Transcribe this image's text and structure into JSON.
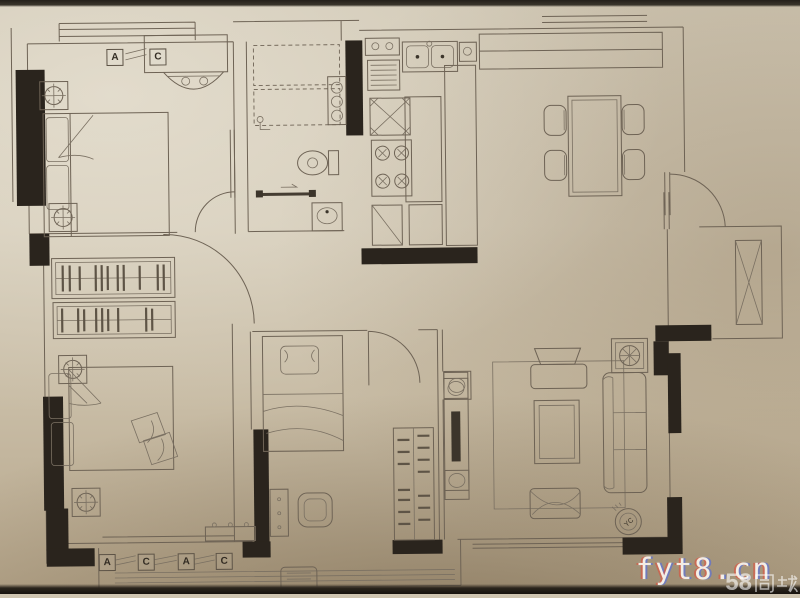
{
  "meta": {
    "paper_color": "#cfc5b1",
    "ink_color": "#6e6355",
    "wall_color": "#2a241d"
  },
  "plan": {
    "ac_labels_top": [
      "A",
      "C"
    ],
    "ac_labels_bottom": [
      "A",
      "C",
      "A",
      "C"
    ],
    "fan_coil_label": "YC"
  },
  "watermarks": {
    "site": "fyt8.cn",
    "portal_number": "58",
    "portal_name": "同城"
  }
}
